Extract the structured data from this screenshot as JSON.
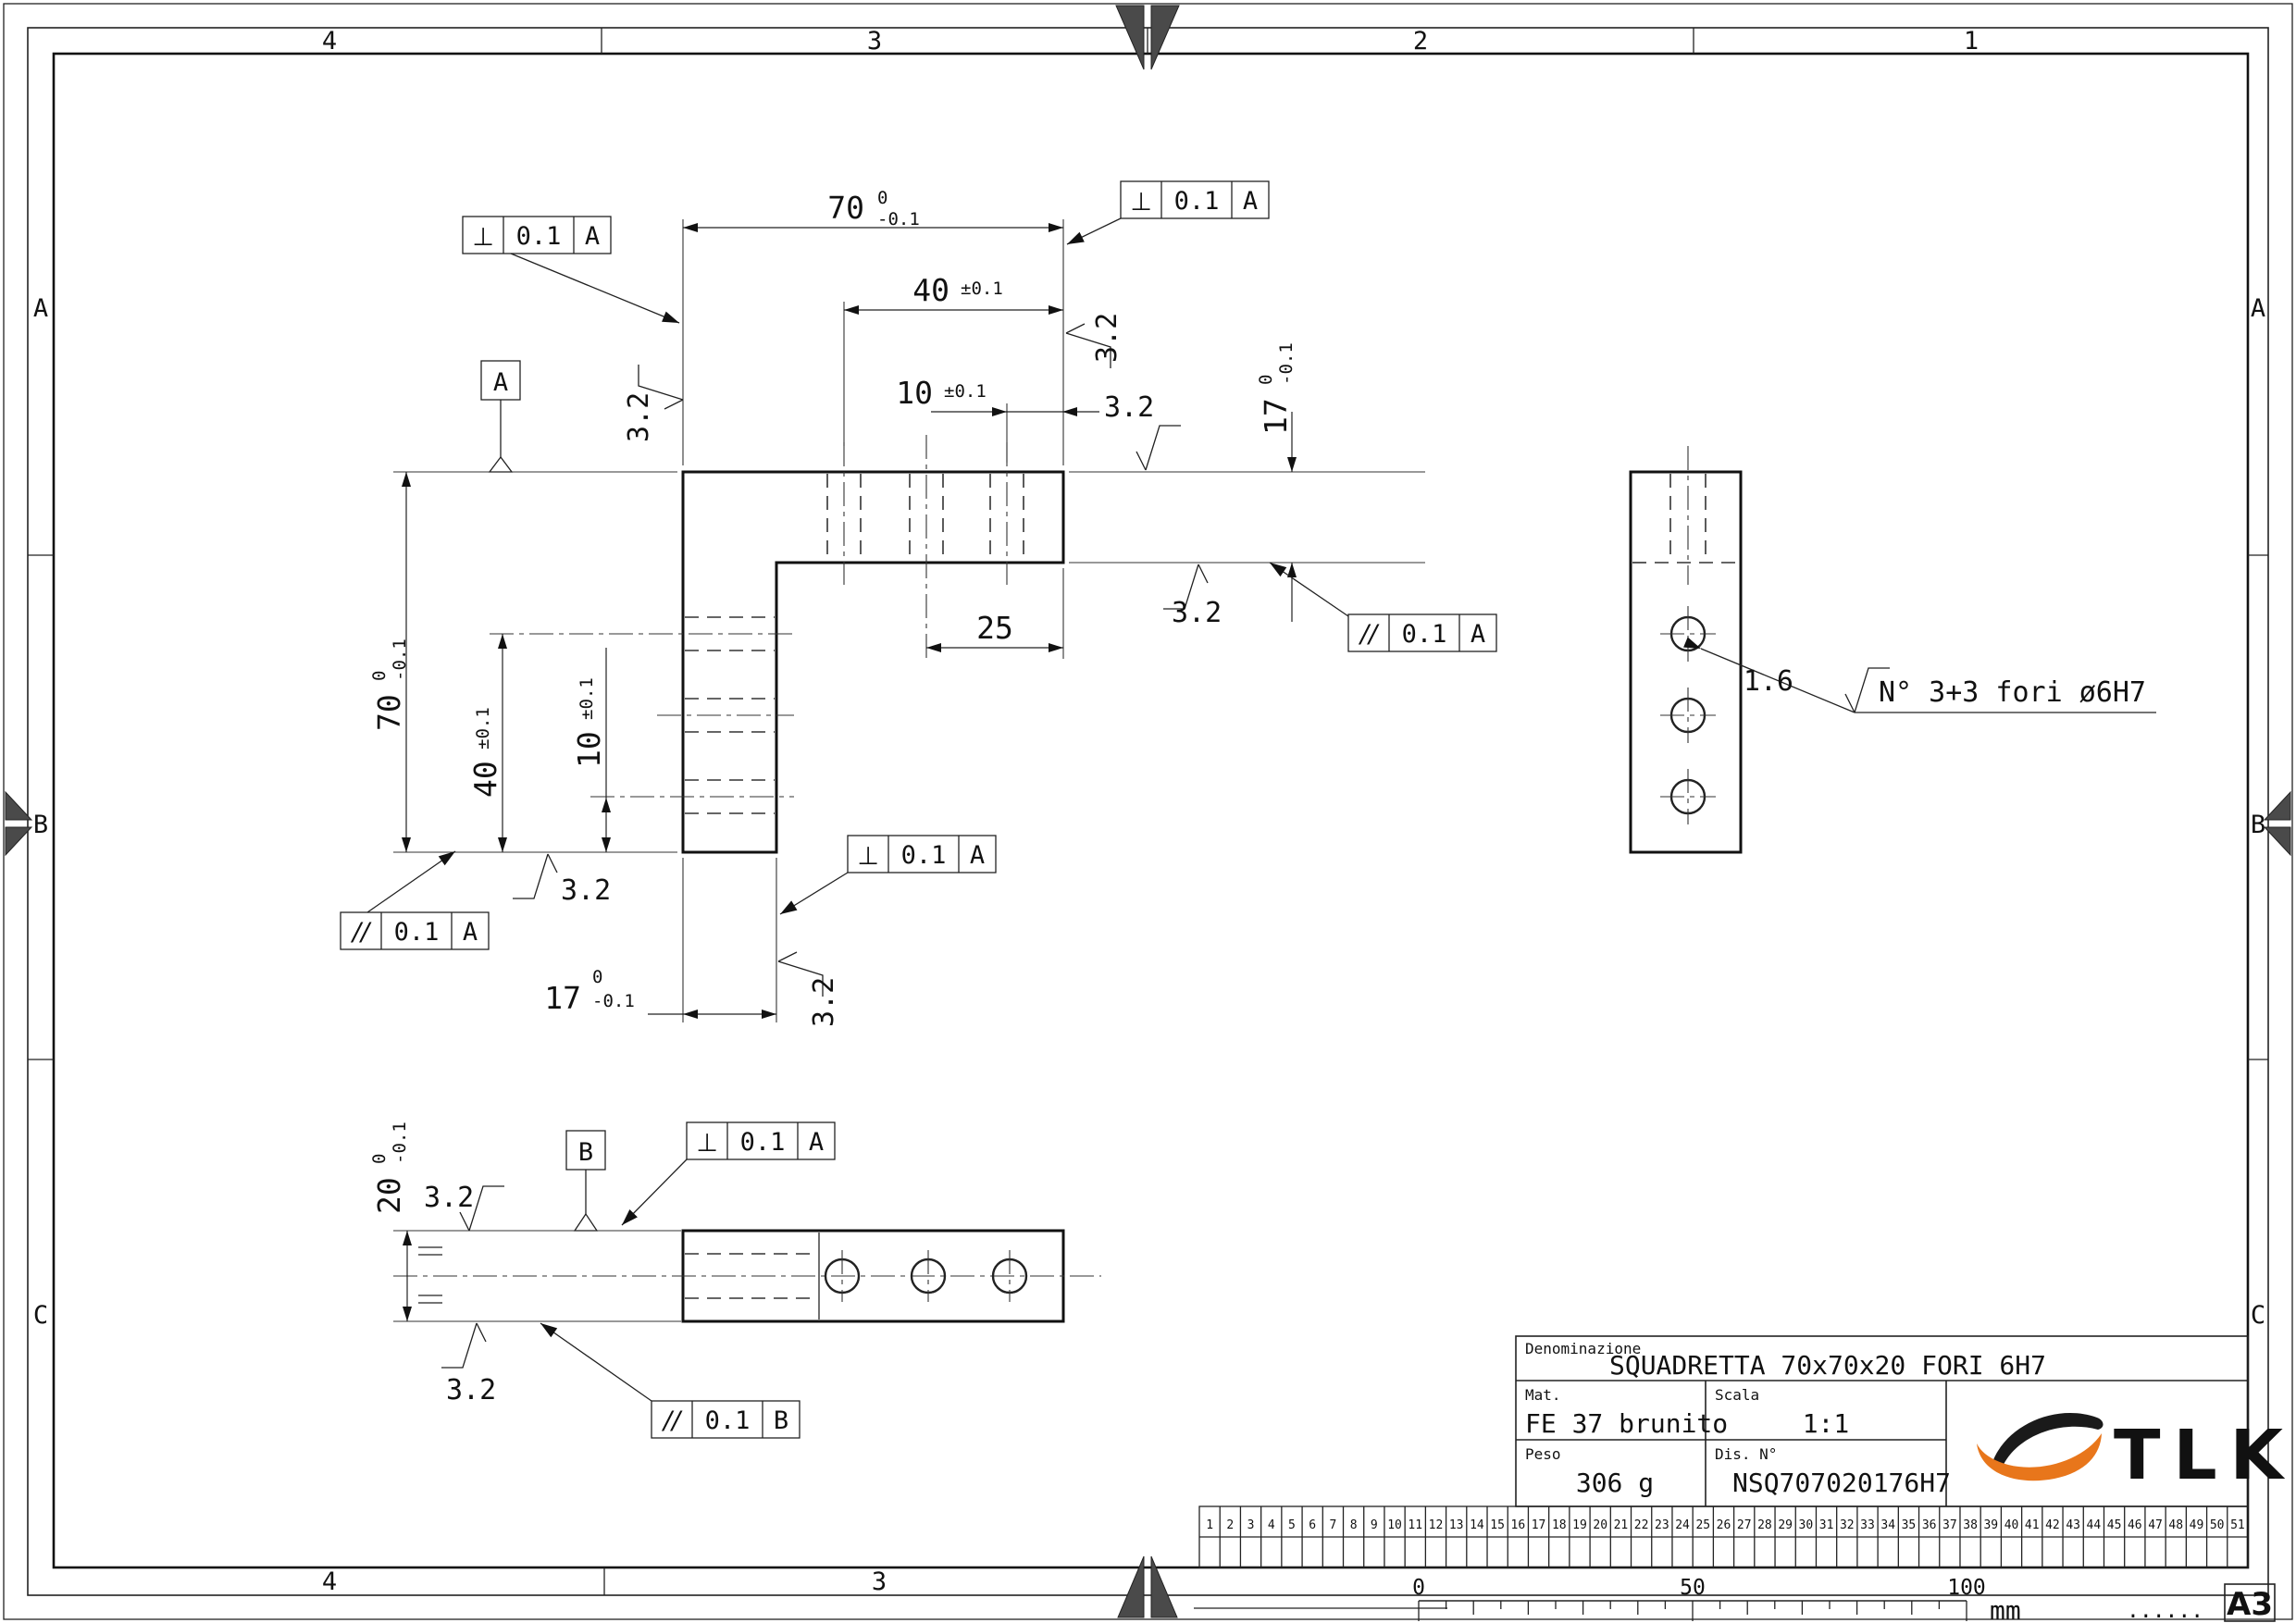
{
  "sheet": {
    "format": "A3",
    "unit": "mm",
    "ruler_dots": "......",
    "ruler_labels": [
      "0",
      "50",
      "100"
    ],
    "zones_top": [
      "4",
      "3",
      "2",
      "1"
    ],
    "zones_bottom": [
      "4",
      "3"
    ],
    "zones_side": [
      "A",
      "B",
      "C"
    ],
    "strip_numbers": [
      "1",
      "2",
      "3",
      "4",
      "5",
      "6",
      "7",
      "8",
      "9",
      "10",
      "11",
      "12",
      "13",
      "14",
      "15",
      "16",
      "17",
      "18",
      "19",
      "20",
      "21",
      "22",
      "23",
      "24",
      "25",
      "26",
      "27",
      "28",
      "29",
      "30",
      "31",
      "32",
      "33",
      "34",
      "35",
      "36",
      "37",
      "38",
      "39",
      "40",
      "41",
      "42",
      "43",
      "44",
      "45",
      "46",
      "47",
      "48",
      "49",
      "50",
      "51"
    ]
  },
  "title_block": {
    "denominazione_label": "Denominazione",
    "denominazione": "SQUADRETTA 70x70x20 FORI 6H7",
    "mat_label": "Mat.",
    "mat": "FE 37 brunito",
    "scala_label": "Scala",
    "scala": "1:1",
    "peso_label": "Peso",
    "peso": "306 g",
    "dis_label": "Dis. N°",
    "dis": "NSQ707020176H7",
    "logo_text": "TLK",
    "logo_orange": "#E8761B",
    "logo_black": "#1a1a1a"
  },
  "annotations": {
    "hole_note": "N° 3+3 fori ø6H7",
    "finish_general": "3.2",
    "finish_fine": "1.6"
  },
  "dimensions": {
    "d70": "70",
    "d70_up": "0",
    "d70_lo": "-0.1",
    "d40": "40",
    "d40_tol": "±0.1",
    "d10": "10",
    "d10_tol": "±0.1",
    "d25": "25",
    "d17": "17",
    "d17_up": "0",
    "d17_lo": "-0.1",
    "d20": "20",
    "d20_up": "0",
    "d20_lo": "-0.1"
  },
  "gdt": {
    "perp": "⊥",
    "par": "//",
    "tol": "0.1",
    "datum_a": "A",
    "datum_b": "B"
  }
}
